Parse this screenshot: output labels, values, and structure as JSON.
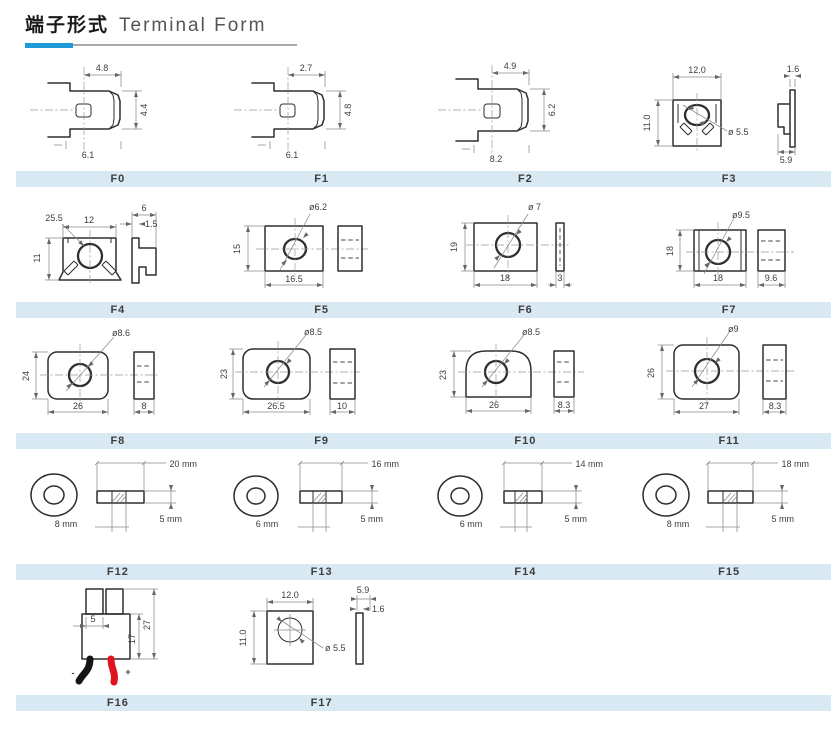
{
  "header": {
    "title_zh": "端子形式",
    "title_en": "Terminal Form"
  },
  "colors": {
    "accent": "#1e9ad6",
    "bar_bg": "#d8e9f3",
    "line": "#2e2e2e",
    "wire_red": "#e0131f",
    "wire_black": "#151515"
  },
  "terminals": {
    "f0": {
      "label": "F0",
      "top": "4.8",
      "right": "4.4",
      "bottom": "6.1"
    },
    "f1": {
      "label": "F1",
      "top": "2.7",
      "right": "4.8",
      "bottom": "6.1"
    },
    "f2": {
      "label": "F2",
      "top": "4.9",
      "right": "6.2",
      "bottom": "8.2"
    },
    "f3": {
      "label": "F3",
      "top": "12.0",
      "left": "11.0",
      "dia": "ø 5.5",
      "side_top": "1.6",
      "side_bottom": "5.9"
    },
    "f4": {
      "label": "F4",
      "leader": "25.5",
      "top": "12",
      "left": "11",
      "side_top": "6",
      "side_inner": "1.5"
    },
    "f5": {
      "label": "F5",
      "dia": "ø6.2",
      "left": "15",
      "bottom": "16.5"
    },
    "f6": {
      "label": "F6",
      "dia": "ø 7",
      "left": "19",
      "bottom": "18",
      "side": "3"
    },
    "f7": {
      "label": "F7",
      "dia": "ø9.5",
      "left": "18",
      "bottom": "18",
      "side": "9.6"
    },
    "f8": {
      "label": "F8",
      "dia": "ø8.6",
      "left": "24",
      "bottom": "26",
      "side": "8"
    },
    "f9": {
      "label": "F9",
      "dia": "ø8.5",
      "left": "23",
      "bottom": "26.5",
      "side": "10"
    },
    "f10": {
      "label": "F10",
      "dia": "ø8.5",
      "left": "23",
      "bottom": "26",
      "side": "8.3"
    },
    "f11": {
      "label": "F11",
      "dia": "ø9",
      "left": "26",
      "bottom": "27",
      "side": "8.3"
    },
    "f12": {
      "label": "F12",
      "hole": "8 mm",
      "width": "20 mm",
      "thickness": "5 mm"
    },
    "f13": {
      "label": "F13",
      "hole": "6 mm",
      "width": "16 mm",
      "thickness": "5 mm"
    },
    "f14": {
      "label": "F14",
      "hole": "6 mm",
      "width": "14 mm",
      "thickness": "5 mm"
    },
    "f15": {
      "label": "F15",
      "hole": "8 mm",
      "width": "18 mm",
      "thickness": "5 mm"
    },
    "f16": {
      "label": "F16",
      "inner": "5",
      "body": "17",
      "total": "27",
      "minus": "-",
      "plus": "+"
    },
    "f17": {
      "label": "F17",
      "top": "12.0",
      "left": "11.0",
      "dia": "ø 5.5",
      "side_top": "5.9",
      "side_right": "1.6"
    }
  }
}
